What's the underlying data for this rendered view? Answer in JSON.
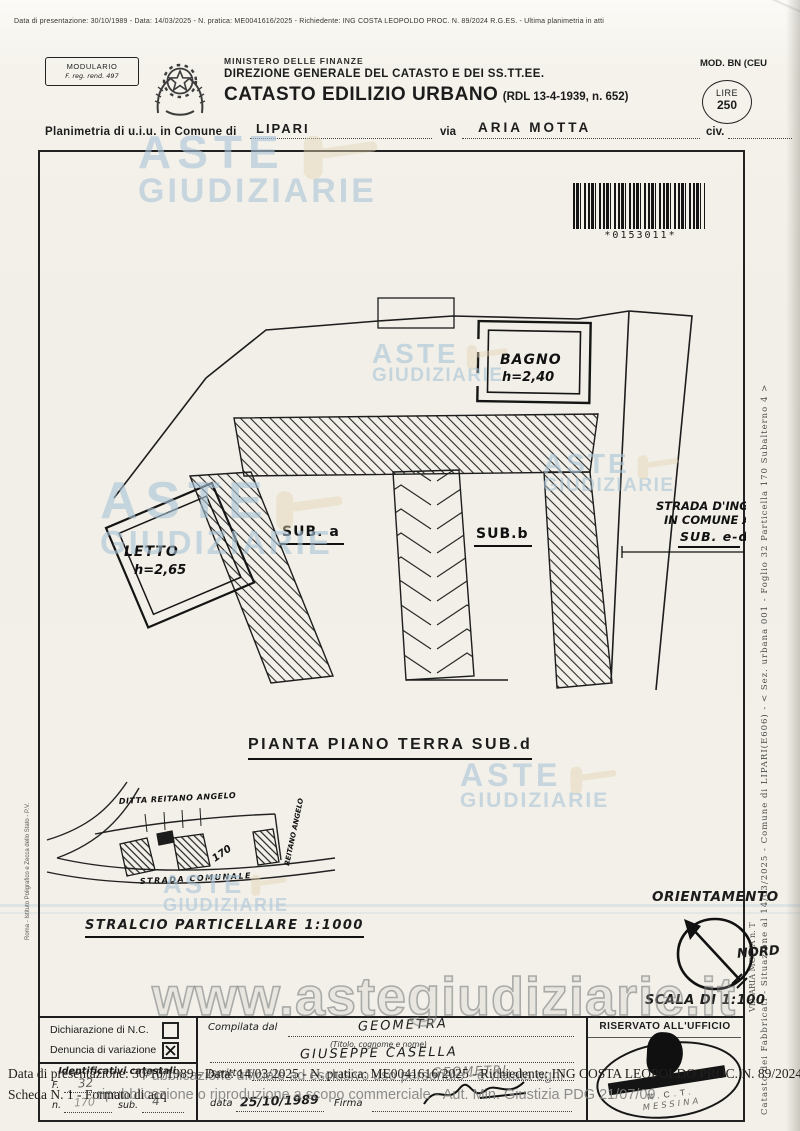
{
  "page": {
    "top_strip": "Data di presentazione: 30/10/1989 - Data: 14/03/2025 - N. pratica: ME0041616/2025 - Richiedente: ING COSTA LEOPOLDO PROC. N. 89/2024 R.G.ES. - Ultima planimetria in atti"
  },
  "header": {
    "modulario_line1": "MODULARIO",
    "modulario_line2": "F. reg. rend. 497",
    "ministry": "MINISTERO DELLE FINANZE",
    "direction": "DIREZIONE GENERALE DEL CATASTO E DEI SS.TT.EE.",
    "title": "CATASTO EDILIZIO URBANO",
    "title_suffix": "(RDL 13-4-1939, n. 652)",
    "mod": "MOD. BN (CEU",
    "lire_label": "LIRE",
    "lire_value": "250"
  },
  "location_line": {
    "prefix": "Planimetria di u.i.u. in Comune di",
    "comune": "LIPARI",
    "via_label": "via",
    "via_value": "ARIA MOTTA",
    "civ_label": "civ."
  },
  "barcode": {
    "text": "*0153011*"
  },
  "plan": {
    "bagno_label": "BAGNO",
    "bagno_h": "h=2,40",
    "letto_label": "LETTO",
    "letto_h": "h=2,65",
    "sub_a": "SUB. a",
    "sub_b": "SUB.b",
    "strada_line1": "STRADA D'INGRES",
    "strada_line2": "IN COMUNE AI",
    "strada_line3": "SUB. e-d",
    "title": "PIANTA PIANO TERRA SUB.d"
  },
  "stralcio": {
    "ditta": "DITTA REITANO ANGELO",
    "parcel": "170",
    "strada": "STRADA COMUNALE",
    "side_vertical": "REITANO ANGELO",
    "title": "STRALCIO PARTICELLARE 1:1000"
  },
  "orientation": {
    "title": "ORIENTAMENTO",
    "nord": "NORD",
    "scala": "SCALA DI 1:100"
  },
  "form": {
    "dichiarazione": "Dichiarazione di N.C.",
    "dichiarazione_checked": false,
    "denuncia": "Denuncia di variazione",
    "denuncia_checked": true,
    "identificativi": "Identificativi catastali",
    "f_label": "F.",
    "f_value": "32",
    "n_label": "n.",
    "n_value": "170",
    "sub_label": "sub.",
    "sub_value": "4",
    "compilata": "Compilata dal",
    "compilata_value": "GEOMETRA",
    "titolo_hint": "(Titolo, cognome e nome)",
    "nome_value": "GIUSEPPE CASELLA",
    "iscritto_label": "Iscritto",
    "iscritto_value": "GEOMETRI",
    "data_label": "data",
    "data_value": "25/10/1989",
    "firma_label": "Firma",
    "riservato": "RISERVATO ALL'UFFICIO",
    "stamp_line1": "N.C.T.",
    "stamp_line2": "MESSINA"
  },
  "overlays": {
    "watermark_line1": "ASTE",
    "watermark_line2": "GIUDIZIARIE",
    "watermark_url": "www.astegiudiziarie.it",
    "bottom_line1": "Data di presentazione: 30/10/1989 - Data: 14/03/2025 - N. pratica: ME0041616/2025 - Richiedente: ING COSTA LEOPOLDO PROC. N. 89/2024 R.G.ES.",
    "bottom_line2": "Scheda N. 1 - Formato di acq",
    "disclaimer_line1": "Pubblicazione ufficiale ad esclusivo uso personale - è vietata ogni",
    "disclaimer_line2": "ripubblicazione o riproduzione a scopo commerciale - Aut. Min. Giustizia PDG 21/07/09"
  },
  "edges": {
    "right_vertical": "Catasto dei Fabbricati - Situazione al 14/03/2025 - Comune di LIPARI(E606) - < Sez. urbana 001 - Foglio 32 Particella 170 Subalterno 4 >",
    "right_vertical2": "VIA ARIA MOTTA n. T",
    "left_vertical": "Roma - Istituto Poligrafico e Zecca dello Stato - P.V."
  }
}
